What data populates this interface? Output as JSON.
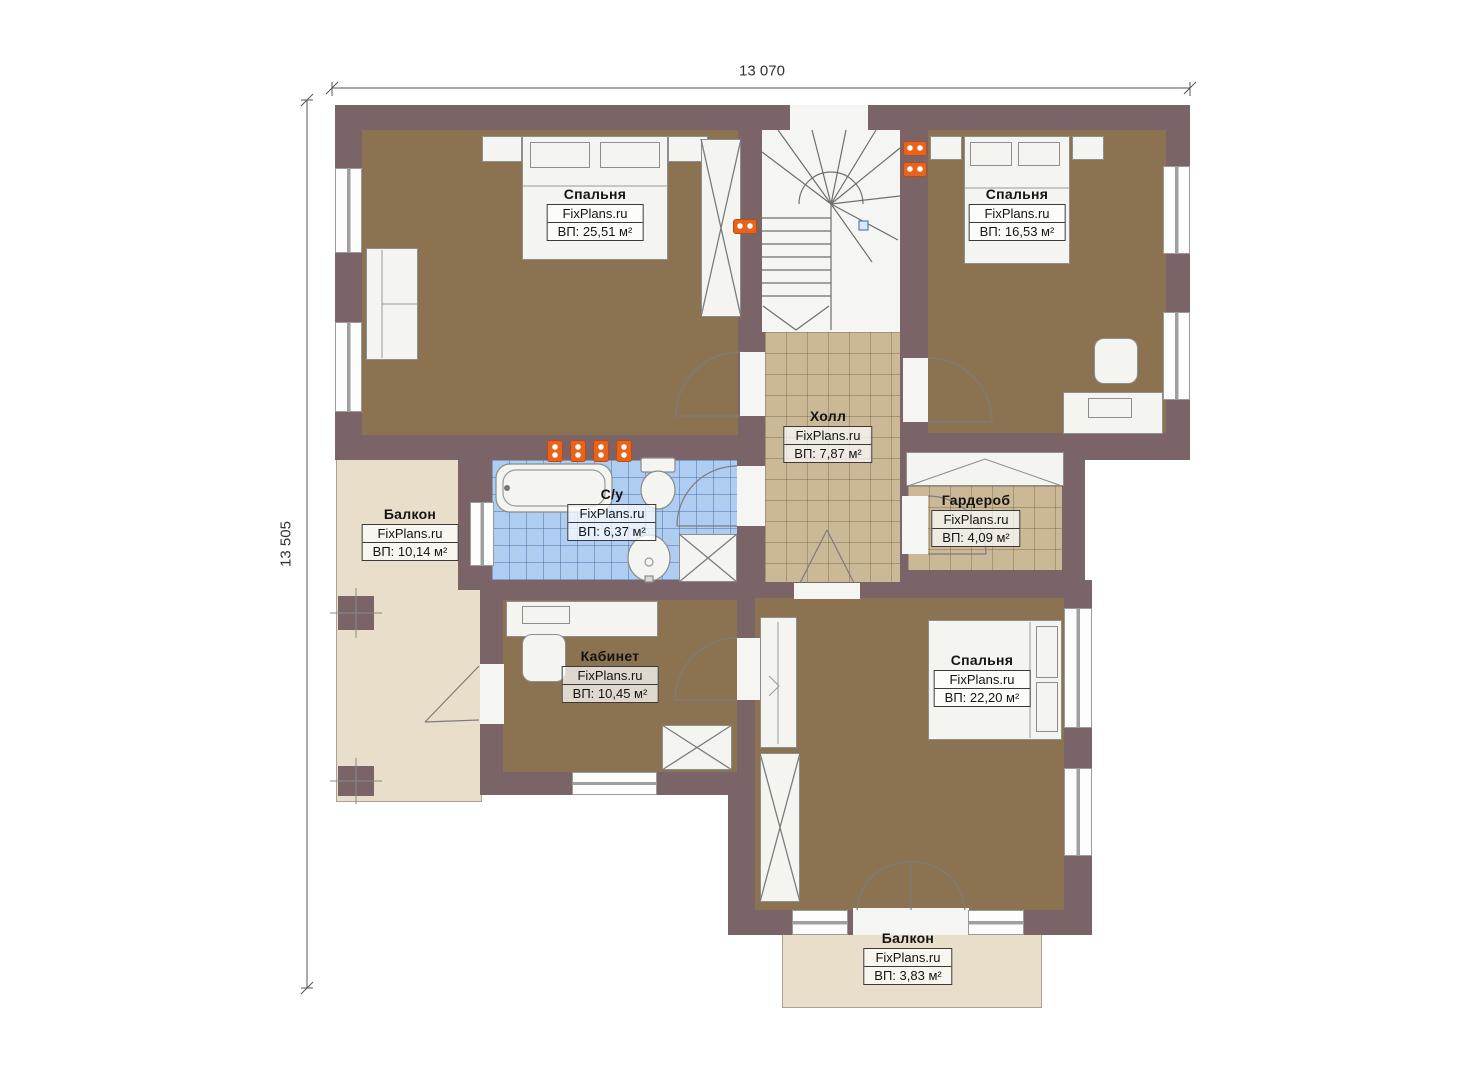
{
  "plan": {
    "type": "floor-plan",
    "watermark": "FixPlans.ru",
    "dimensions": {
      "width_label": "13 070",
      "height_label": "13 505"
    }
  },
  "rooms": [
    {
      "id": "bedroom-1",
      "name": "Спальня",
      "brand": "FixPlans.ru",
      "area": "ВП: 25,51 м²"
    },
    {
      "id": "bedroom-2",
      "name": "Спальня",
      "brand": "FixPlans.ru",
      "area": "ВП: 16,53 м²"
    },
    {
      "id": "hall",
      "name": "Холл",
      "brand": "FixPlans.ru",
      "area": "ВП: 7,87 м²"
    },
    {
      "id": "bathroom",
      "name": "С/у",
      "brand": "FixPlans.ru",
      "area": "ВП: 6,37 м²"
    },
    {
      "id": "balcony-left",
      "name": "Балкон",
      "brand": "FixPlans.ru",
      "area": "ВП: 10,14 м²"
    },
    {
      "id": "wardrobe",
      "name": "Гардероб",
      "brand": "FixPlans.ru",
      "area": "ВП: 4,09 м²"
    },
    {
      "id": "office",
      "name": "Кабинет",
      "brand": "FixPlans.ru",
      "area": "ВП: 10,45 м²"
    },
    {
      "id": "bedroom-3",
      "name": "Спальня",
      "brand": "FixPlans.ru",
      "area": "ВП: 22,20 м²"
    },
    {
      "id": "balcony-bottom",
      "name": "Балкон",
      "brand": "FixPlans.ru",
      "area": "ВП: 3,83 м²"
    }
  ],
  "colors": {
    "wall": "#7a6468",
    "bedroom_floor": "#8b7352",
    "tile_tan": "#cab896",
    "tile_blue": "#aecdf0",
    "balcony_floor": "#e8dec9",
    "stair_floor": "#f5f5f3",
    "light_fixture": "#e8641c"
  }
}
